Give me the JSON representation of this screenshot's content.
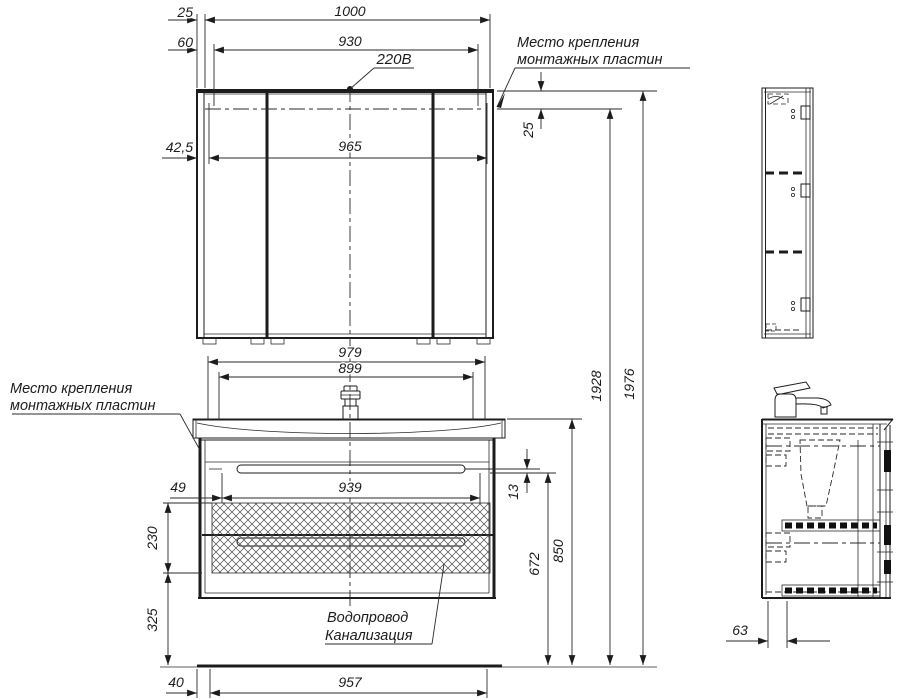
{
  "dims": {
    "top_offset_25": "25",
    "total_width_1000": "1000",
    "offset_60": "60",
    "inner_width_930": "930",
    "power_outlet": "220В",
    "plate_offset_42_5": "42,5",
    "plate_span_965": "965",
    "side_plate_25": "25",
    "vanity_width_979": "979",
    "vanity_inner_899": "899",
    "drawer_offset_49": "49",
    "drawer_span_939": "939",
    "groove_13": "13",
    "zone_height_230": "230",
    "zone_floor_325": "325",
    "bottom_offset_40": "40",
    "bottom_span_957": "957",
    "height_672": "672",
    "height_850": "850",
    "height_1928": "1928",
    "height_1976": "1976",
    "depth_offset_63": "63"
  },
  "notes": {
    "mount_top_line1": "Место крепления",
    "mount_top_line2": "монтажных пластин",
    "mount_left_line1": "Место крепления",
    "mount_left_line2": "монтажных пластин",
    "plumbing_line1": "Водопровод",
    "plumbing_line2": "Канализация"
  }
}
